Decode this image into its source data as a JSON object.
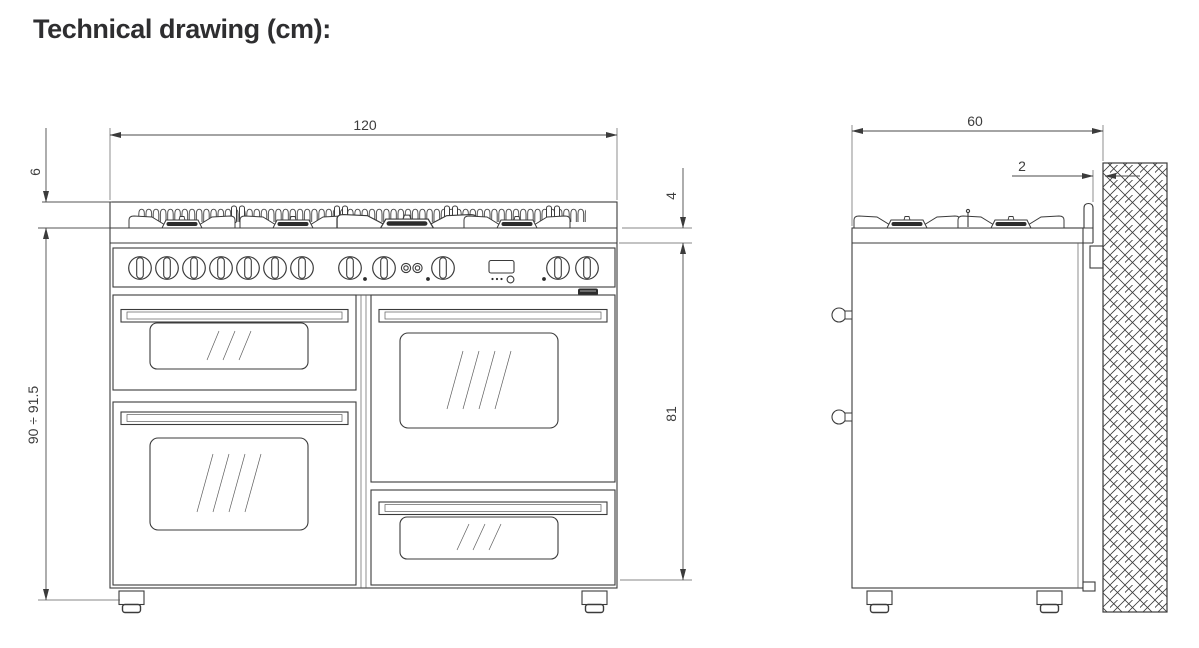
{
  "title": "Technical drawing (cm):",
  "dimensions": {
    "front_width": "120",
    "grate_height": "6",
    "overall_height_range": "90 ÷ 91.5",
    "hob_edge_thickness": "4",
    "body_height": "81",
    "side_depth": "60",
    "wall_clearance": "2"
  },
  "views": {
    "front_label": "front view of range cooker",
    "side_label": "side view of range cooker against hatched wall"
  },
  "colors": {
    "background": "#ffffff",
    "line": "#3b3b3b",
    "dimension_text": "#3d3d3d",
    "title_text": "#2e2e30"
  }
}
